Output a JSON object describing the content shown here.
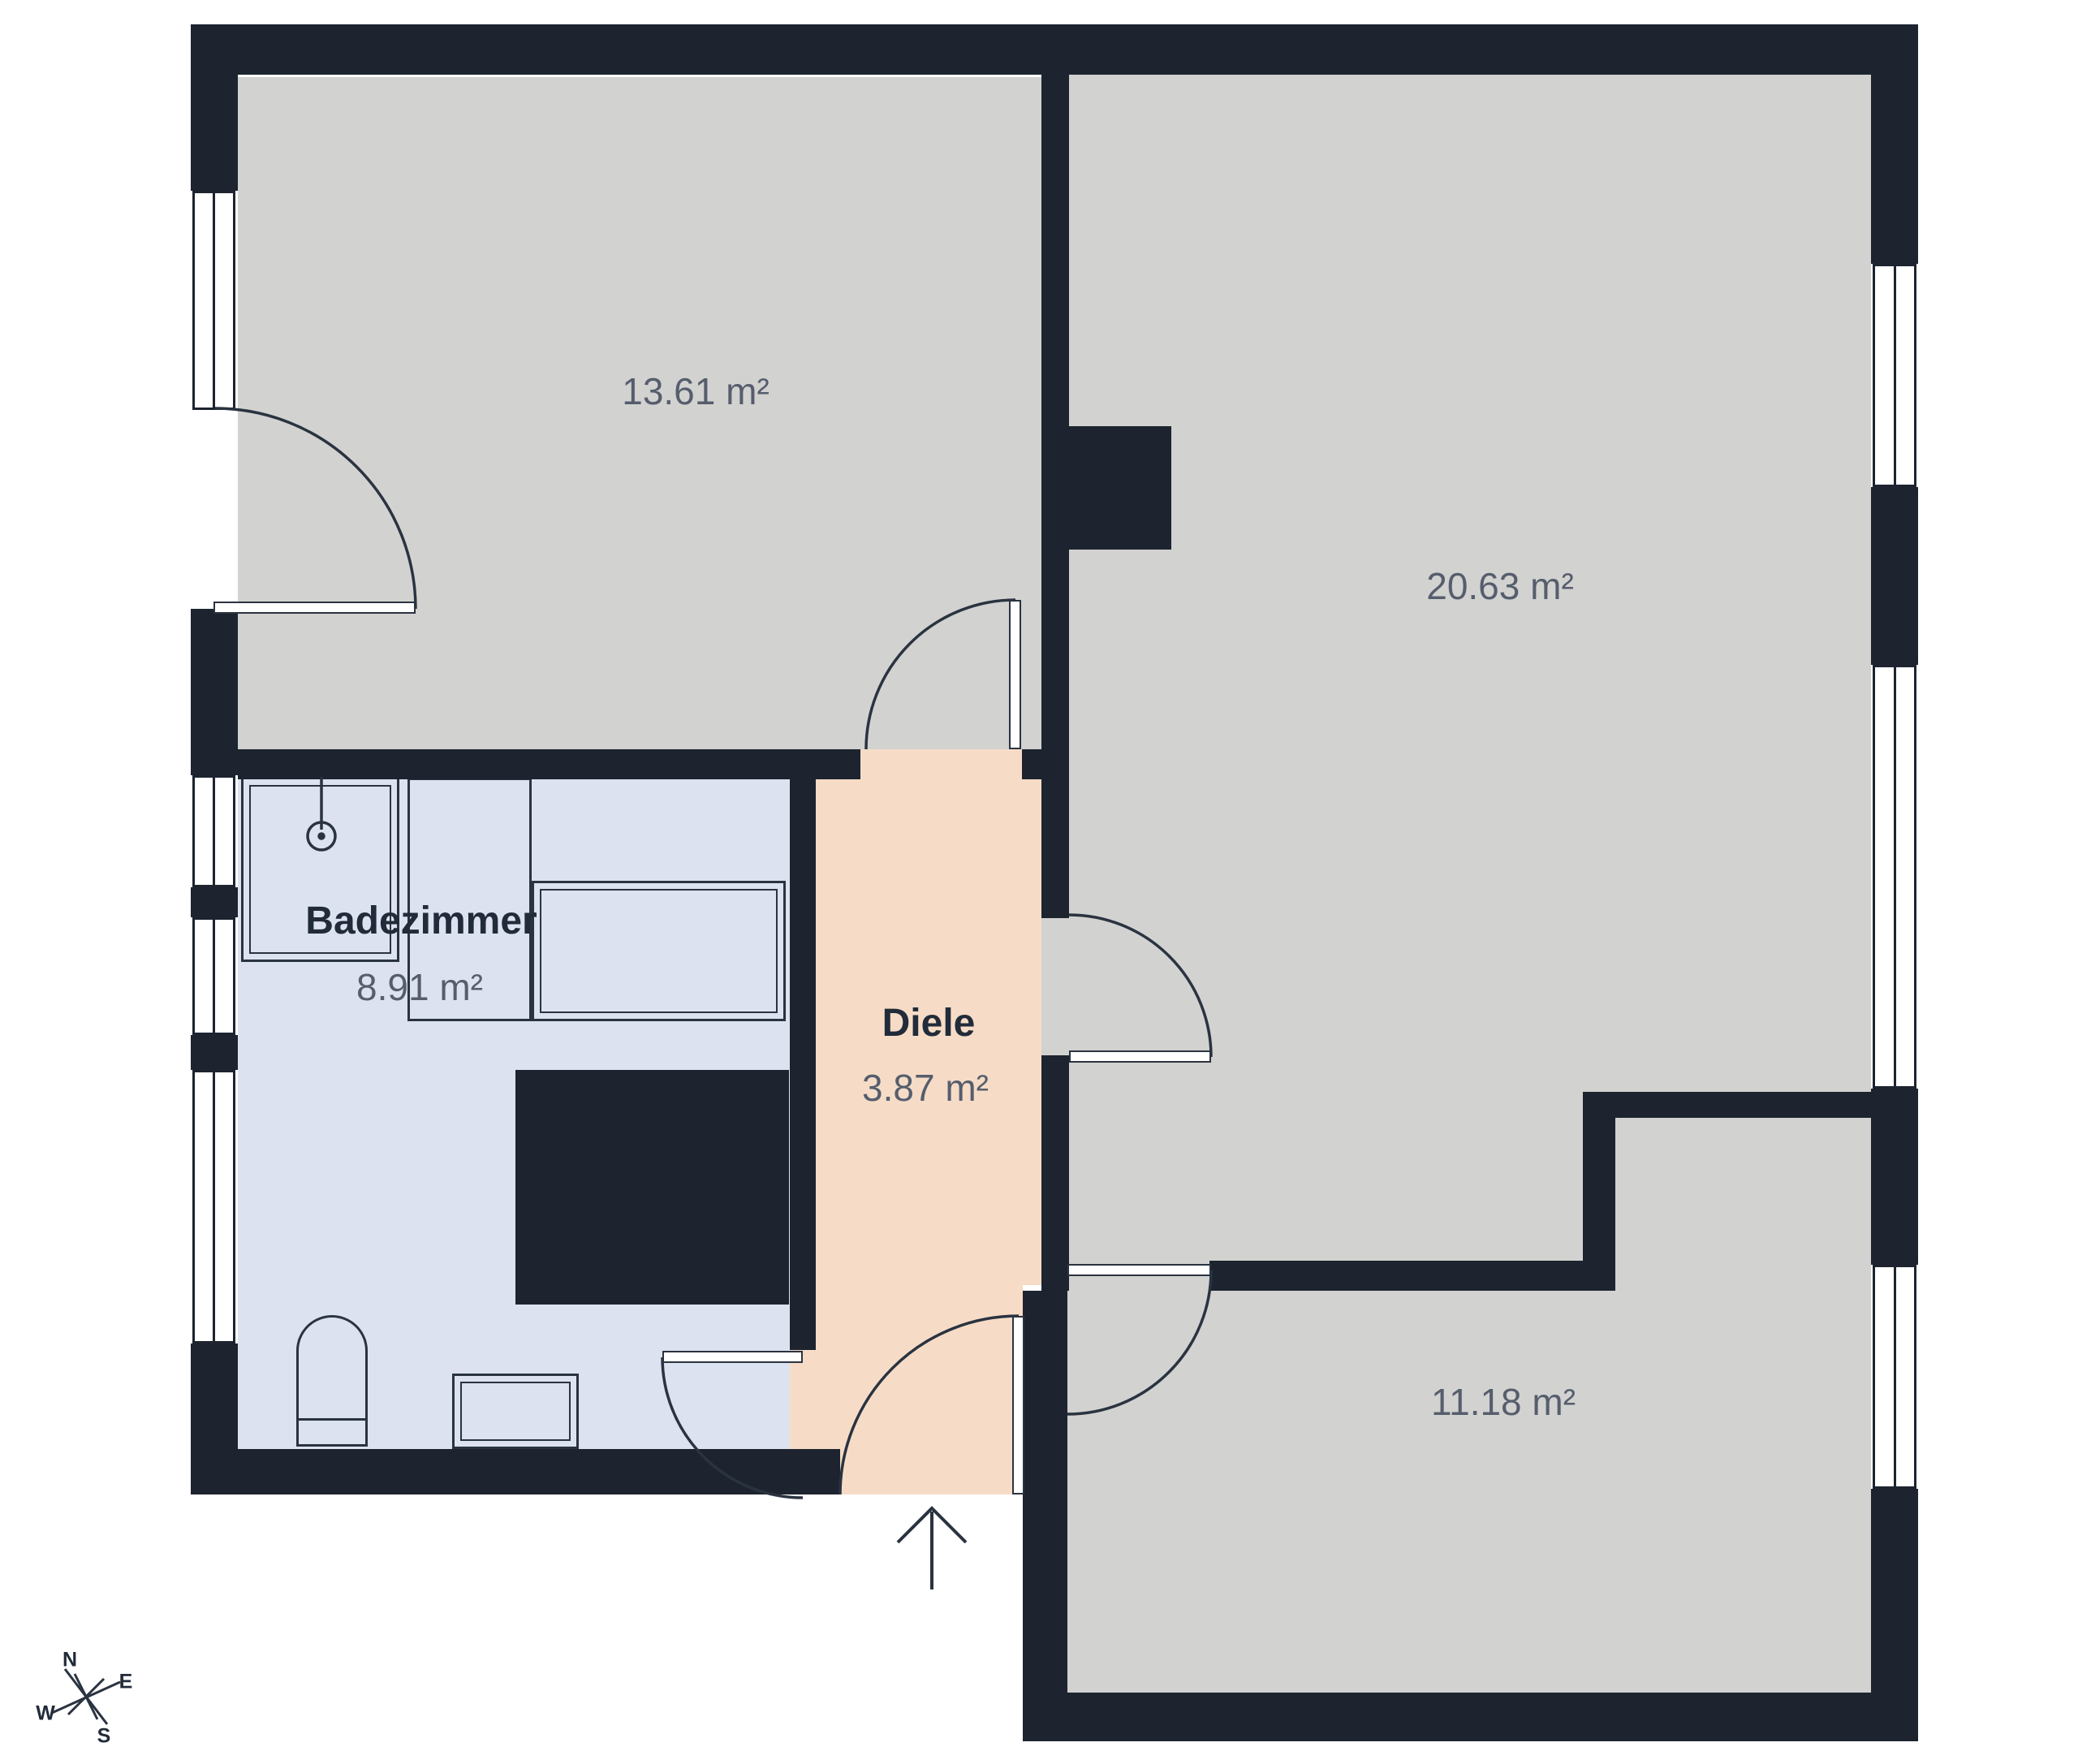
{
  "plan": {
    "rooms": [
      {
        "id": "room-13-61",
        "name": "",
        "area_label": "13.61 m²"
      },
      {
        "id": "room-20-63",
        "name": "",
        "area_label": "20.63 m²"
      },
      {
        "id": "badezimmer",
        "name": "Badezimmer",
        "area_label": "8.91 m²"
      },
      {
        "id": "diele",
        "name": "Diele",
        "area_label": "3.87 m²"
      },
      {
        "id": "room-11-18",
        "name": "",
        "area_label": "11.18 m²"
      }
    ],
    "compass": {
      "north": "N",
      "east": "E",
      "south": "S",
      "west": "W"
    },
    "colors": {
      "wall": "#1d2430",
      "room_fill": "#d2d2d0",
      "bathroom_fill": "#dde2f0",
      "hall_fill": "#f6dcc7",
      "label_gray": "#565e6d",
      "label_dark": "#212b39"
    }
  }
}
